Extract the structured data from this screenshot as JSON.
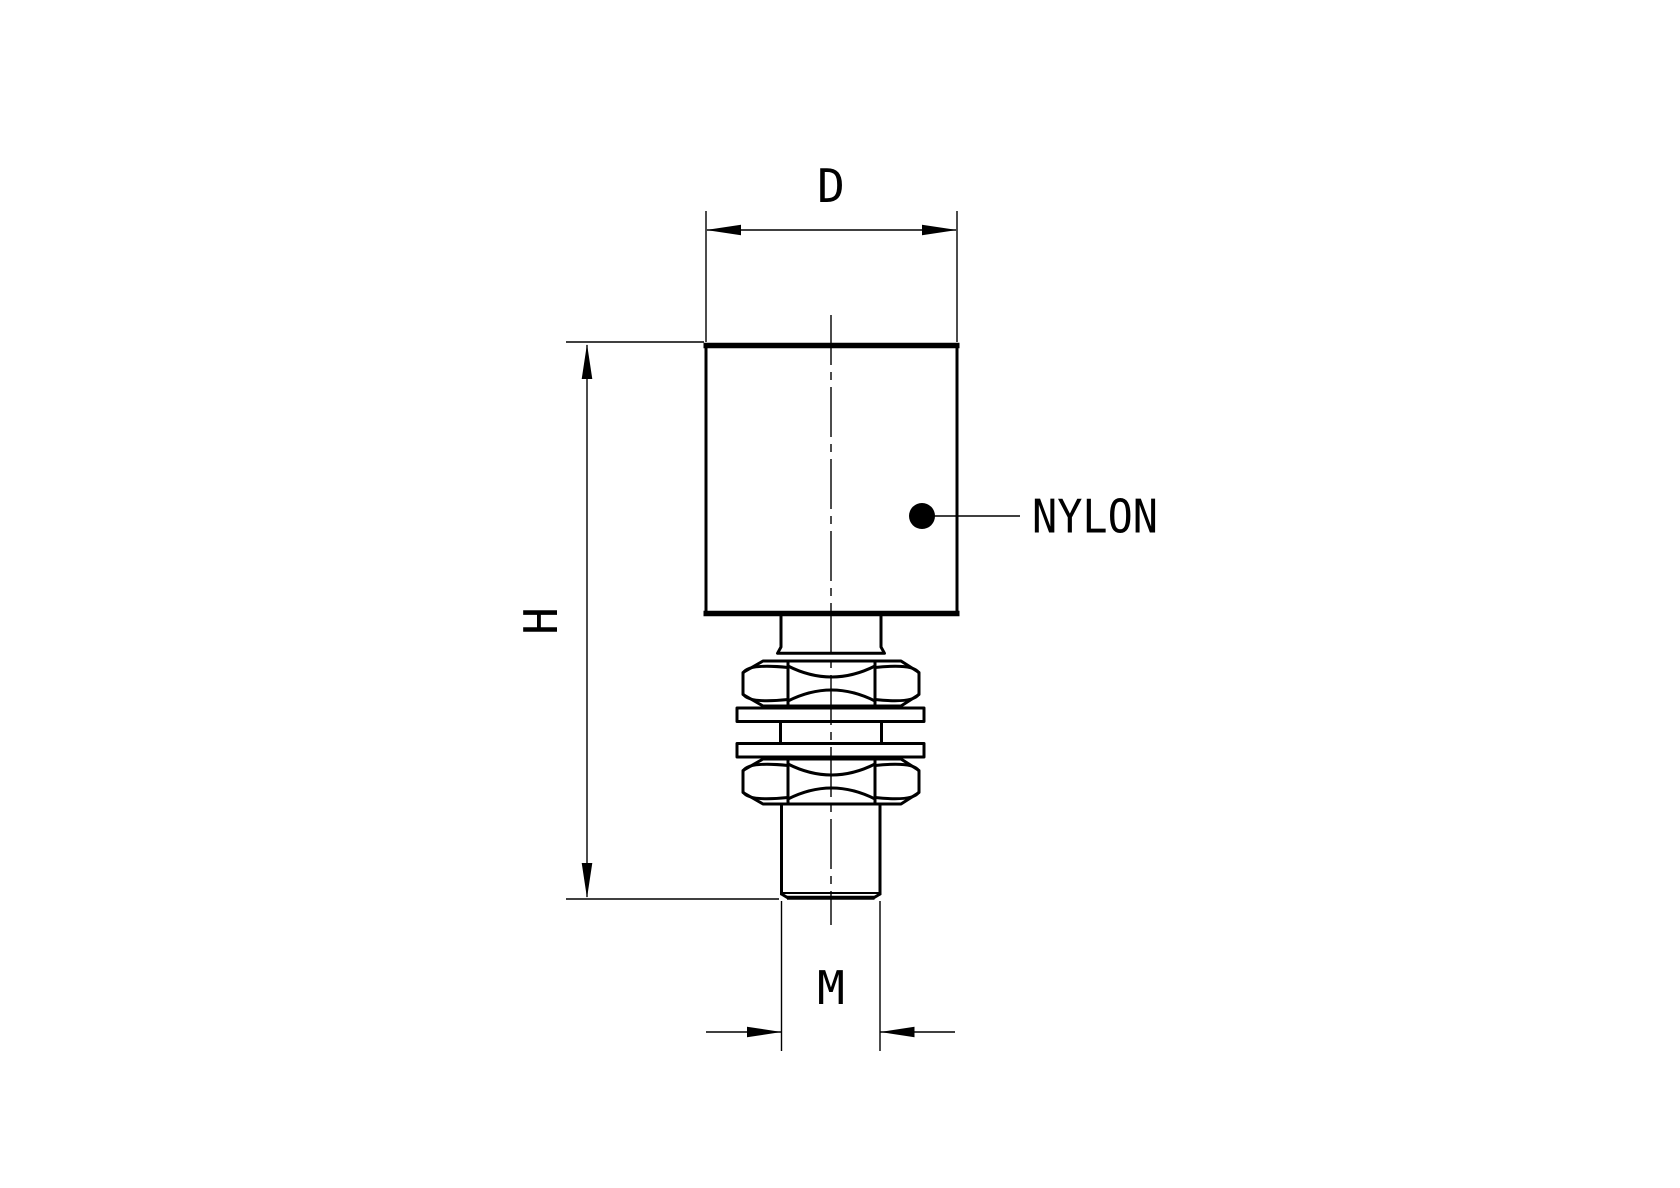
{
  "drawing": {
    "labels": {
      "diameter": "D",
      "overall_height": "H",
      "thread_size": "M",
      "material": "NYLON"
    },
    "colors": {
      "line": "#000000",
      "background": "#ffffff"
    }
  }
}
